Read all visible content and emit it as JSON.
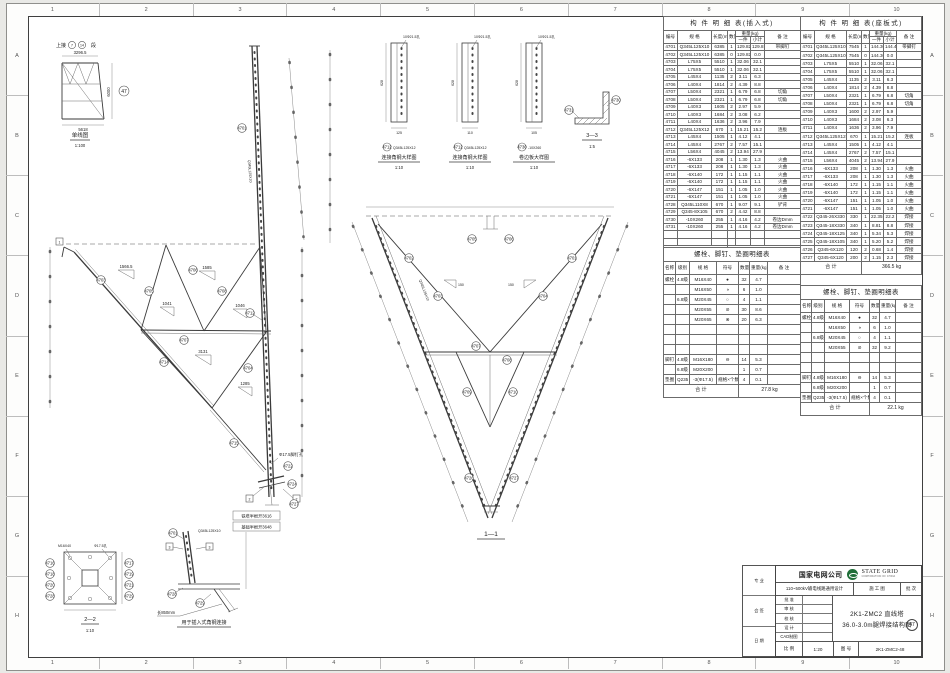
{
  "grid": {
    "cols": [
      "1",
      "2",
      "3",
      "4",
      "5",
      "6",
      "7",
      "8",
      "9",
      "10"
    ],
    "rows": [
      "A",
      "B",
      "C",
      "D",
      "E",
      "F",
      "G",
      "H"
    ]
  },
  "single_line": {
    "link_prefix": "上接",
    "seg1": "7",
    "seg2": "14",
    "link_suffix": "段",
    "dim_top": "3296.5",
    "dim_bottom": "5618",
    "dim_right": "6000",
    "ref": "47",
    "caption": "单线图",
    "scale": "1:100"
  },
  "refs": {
    "47": "47",
    "4701": "4701",
    "4702": "4702",
    "4703": "4703",
    "4704": "4704",
    "4705": "4705",
    "4706": "4706",
    "4707": "4707",
    "4708": "4708",
    "4709": "4709",
    "4710": "4710",
    "4712": "4712",
    "4713": "4713",
    "4714": "4714",
    "4715": "4715",
    "4716": "4716",
    "4717": "4717",
    "4718": "4718",
    "4719": "4719",
    "4720": "4720",
    "4721": "4721",
    "4722": "4722",
    "4724": "4724",
    "4726": "4726",
    "4727": "4727",
    "4728": "4728",
    "4729": "4729",
    "4730": "4730",
    "4731": "4731"
  },
  "dims": {
    "d1566": "1566.5",
    "d1585": "1585",
    "d1041": "1041",
    "d1046": "1046",
    "d3131": "3131",
    "d1285": "1285",
    "d628": "628",
    "d125": "125",
    "d110": "110",
    "d105": "105",
    "d150": "150"
  },
  "notes": {
    "half_root_tower": "铁塔半根开3616",
    "half_root_found": "基础半根开3648",
    "foot_hole": "Φ17.5脚钉孔",
    "hole10": "10Φ21.5孔",
    "len850": "长850mm",
    "insert_caption": "用于插入式角钢连接",
    "sec11": "1—1",
    "sec22": "2—2",
    "sec33": "3—3",
    "scale110": "1:10",
    "scale15": "1:5",
    "spec_leg": "Q345L125X10",
    "spec_conn": "Q345L125X12",
    "m16": "M16X40",
    "hole17": "Φ17.5孔",
    "f1": "1",
    "f2": "2",
    "f3": "3"
  },
  "strips": [
    {
      "ref": "4712",
      "spec": "Q345L125X12",
      "caption": "连接角钢大样图",
      "scale": "1:10",
      "width": "125"
    },
    {
      "ref": "4712",
      "spec": "Q345L125X12",
      "caption": "连接角钢大样图",
      "scale": "1:10",
      "width": "110"
    },
    {
      "ref": "4730",
      "spec": "-10X260",
      "caption": "卷边板大样图",
      "scale": "1:10",
      "width": "105"
    }
  ],
  "tables": {
    "headers": {
      "no": "编号",
      "spec": "规 格",
      "len": "长度(mm)",
      "qty": "数量",
      "weight": "重量(kg)",
      "one": "一件",
      "sub": "小计",
      "note": "备 注"
    },
    "total_label": "合 计",
    "insert": {
      "title": "构 件 明 细 表(插入式)",
      "total": "338.0 kg",
      "rows": [
        [
          "4701",
          "Q345L125X10",
          "6385",
          "1",
          "129.82",
          "129.8",
          "带脚钉"
        ],
        [
          "4702",
          "Q345L125X10",
          "6385",
          "0",
          "129.82",
          "0.0",
          ""
        ],
        [
          "4703",
          "L75X5",
          "5510",
          "1",
          "32.06",
          "32.1",
          ""
        ],
        [
          "4704",
          "L75X5",
          "5510",
          "1",
          "32.06",
          "32.1",
          ""
        ],
        [
          "4705",
          "L45X4",
          "1135",
          "2",
          "3.11",
          "6.3",
          ""
        ],
        [
          "4706",
          "L40X4",
          "1814",
          "2",
          "4.39",
          "8.8",
          ""
        ],
        [
          "4707",
          "L50X4",
          "2321",
          "1",
          "6.79",
          "6.8",
          "切角"
        ],
        [
          "4708",
          "L50X4",
          "2321",
          "1",
          "6.79",
          "6.8",
          "切角"
        ],
        [
          "4709",
          "L40X3",
          "1605",
          "2",
          "2.97",
          "5.9",
          ""
        ],
        [
          "4710",
          "L40X3",
          "1684",
          "2",
          "3.08",
          "6.2",
          ""
        ],
        [
          "4711",
          "L40X4",
          "1636",
          "2",
          "3.96",
          "7.9",
          ""
        ],
        [
          "4712",
          "Q345L125X12",
          "670",
          "1",
          "15.21",
          "15.2",
          "连板"
        ],
        [
          "4713",
          "L45X4",
          "1505",
          "1",
          "4.12",
          "4.1",
          ""
        ],
        [
          "4714",
          "L45X4",
          "2767",
          "2",
          "7.57",
          "15.1",
          ""
        ],
        [
          "4715",
          "L56X4",
          "4045",
          "2",
          "13.94",
          "27.9",
          ""
        ],
        [
          "4716",
          "-6X133",
          "208",
          "1",
          "1.30",
          "1.3",
          "火曲"
        ],
        [
          "4717",
          "-6X133",
          "208",
          "1",
          "1.30",
          "1.3",
          "火曲"
        ],
        [
          "4718",
          "-6X140",
          "172",
          "1",
          "1.15",
          "1.1",
          "火曲"
        ],
        [
          "4719",
          "-6X140",
          "172",
          "1",
          "1.15",
          "1.1",
          "火曲"
        ],
        [
          "4720",
          "-6X147",
          "151",
          "1",
          "1.05",
          "1.0",
          "火曲"
        ],
        [
          "4721",
          "-6X147",
          "151",
          "1",
          "1.05",
          "1.0",
          "火曲"
        ],
        [
          "4728",
          "Q345L110X8",
          "670",
          "1",
          "9.07",
          "9.1",
          "铲背"
        ],
        [
          "4729",
          "Q345-8X105",
          "670",
          "2",
          "4.42",
          "8.8",
          ""
        ],
        [
          "4730",
          "-10X260",
          "255",
          "1",
          "4.16",
          "4.2",
          "卷边Dmm"
        ],
        [
          "4731",
          "-10X260",
          "255",
          "1",
          "4.16",
          "4.2",
          "卷边Dmm"
        ],
        [
          "",
          "",
          "",
          "",
          "",
          "",
          ""
        ],
        [
          "",
          "",
          "",
          "",
          "",
          "",
          ""
        ]
      ]
    },
    "seat": {
      "title": "构 件 明 细 表(座板式)",
      "total": "366.5 kg",
      "rows": [
        [
          "4701",
          "Q345L125X10",
          "7545",
          "1",
          "144.36",
          "144.4",
          "带脚钉"
        ],
        [
          "4702",
          "Q345L125X10",
          "7545",
          "0",
          "144.36",
          "0.0",
          ""
        ],
        [
          "4703",
          "L75X5",
          "5510",
          "1",
          "32.06",
          "32.1",
          ""
        ],
        [
          "4704",
          "L75X5",
          "5510",
          "1",
          "32.06",
          "32.1",
          ""
        ],
        [
          "4705",
          "L45X4",
          "1135",
          "2",
          "3.11",
          "6.3",
          ""
        ],
        [
          "4706",
          "L40X4",
          "1814",
          "2",
          "4.39",
          "8.8",
          ""
        ],
        [
          "4707",
          "L50X4",
          "2321",
          "1",
          "6.79",
          "6.8",
          "切角"
        ],
        [
          "4708",
          "L50X4",
          "2321",
          "1",
          "6.79",
          "6.8",
          "切角"
        ],
        [
          "4709",
          "L40X3",
          "1600",
          "2",
          "2.97",
          "5.9",
          ""
        ],
        [
          "4710",
          "L40X3",
          "1684",
          "2",
          "3.08",
          "6.3",
          ""
        ],
        [
          "4711",
          "L40X4",
          "1636",
          "2",
          "3.96",
          "7.9",
          ""
        ],
        [
          "4712",
          "Q345L125X12",
          "670",
          "1",
          "15.21",
          "15.2",
          "连板"
        ],
        [
          "4713",
          "L45X4",
          "1505",
          "1",
          "4.12",
          "4.1",
          ""
        ],
        [
          "4714",
          "L45X4",
          "2767",
          "2",
          "7.57",
          "15.1",
          ""
        ],
        [
          "4715",
          "L56X4",
          "4045",
          "2",
          "13.94",
          "27.9",
          ""
        ],
        [
          "4716",
          "-6X133",
          "208",
          "1",
          "1.30",
          "1.3",
          "火曲"
        ],
        [
          "4717",
          "-6X133",
          "208",
          "1",
          "1.30",
          "1.3",
          "火曲"
        ],
        [
          "4718",
          "-6X140",
          "172",
          "1",
          "1.15",
          "1.1",
          "火曲"
        ],
        [
          "4719",
          "-6X140",
          "172",
          "1",
          "1.15",
          "1.1",
          "火曲"
        ],
        [
          "4720",
          "-6X147",
          "151",
          "1",
          "1.05",
          "1.0",
          "火曲"
        ],
        [
          "4721",
          "-6X147",
          "151",
          "1",
          "1.05",
          "1.0",
          "火曲"
        ],
        [
          "4722",
          "Q345-26X330",
          "330",
          "1",
          "22.35",
          "22.2",
          "焊接"
        ],
        [
          "4723",
          "Q345-18X330",
          "340",
          "1",
          "8.81",
          "8.8",
          "焊接"
        ],
        [
          "4724",
          "Q345-18X125",
          "340",
          "1",
          "5.34",
          "5.3",
          "焊接"
        ],
        [
          "4725",
          "Q345-18X105",
          "340",
          "1",
          "5.20",
          "5.2",
          "焊接"
        ],
        [
          "4726",
          "Q345-6X120",
          "120",
          "2",
          "0.68",
          "1.4",
          "焊接"
        ],
        [
          "4727",
          "Q345-6X120",
          "200",
          "2",
          "1.15",
          "2.3",
          "焊接"
        ]
      ]
    },
    "bolt_headers": [
      "名称",
      "级别",
      "规 格",
      "符号",
      "数量",
      "重量(kg)",
      "备 注"
    ],
    "bolts_insert": {
      "title": "螺栓、脚钉、垫圈明细表",
      "total": "27.8 kg",
      "rows": [
        [
          "螺栓",
          "4.8级",
          "M16X40",
          "●",
          "32",
          "4.7",
          ""
        ],
        [
          "",
          "",
          "M16X50",
          "◑",
          "6",
          "1.0",
          ""
        ],
        [
          "",
          "6.8级",
          "M20X45",
          "○",
          "4",
          "1.1",
          ""
        ],
        [
          "",
          "",
          "M20X55",
          "⊘",
          "30",
          "8.6",
          ""
        ],
        [
          "",
          "",
          "M20X65",
          "⊗",
          "20",
          "6.3",
          ""
        ],
        [
          "",
          "",
          "",
          "",
          "",
          "",
          ""
        ],
        [
          "",
          "",
          "",
          "",
          "",
          "",
          ""
        ],
        [
          "",
          "",
          "",
          "",
          "",
          "",
          ""
        ],
        [
          "脚钉",
          "4.8级",
          "M16X180",
          "⊖",
          "14",
          "5.3",
          ""
        ],
        [
          "",
          "6.8级",
          "M20X200",
          "",
          "1",
          "0.7",
          ""
        ],
        [
          "垫圈",
          "Q235",
          "-3(Φ17.5)",
          "规格×个数",
          "4",
          "0.1",
          ""
        ]
      ]
    },
    "bolts_seat": {
      "title": "螺栓、脚钉、垫圈明细表",
      "total": "22.1 kg",
      "rows": [
        [
          "螺栓",
          "4.8级",
          "M16X40",
          "●",
          "32",
          "4.7",
          ""
        ],
        [
          "",
          "",
          "M16X50",
          "◑",
          "6",
          "1.0",
          ""
        ],
        [
          "",
          "6.8级",
          "M20X45",
          "○",
          "4",
          "1.1",
          ""
        ],
        [
          "",
          "",
          "M20X55",
          "⊘",
          "32",
          "9.2",
          ""
        ],
        [
          "",
          "",
          "",
          "",
          "",
          "",
          ""
        ],
        [
          "",
          "",
          "",
          "",
          "",
          "",
          ""
        ],
        [
          "脚钉",
          "4.8级",
          "M16X180",
          "⊖",
          "14",
          "5.3",
          ""
        ],
        [
          "",
          "6.8级",
          "M20X200",
          "",
          "1",
          "0.7",
          ""
        ],
        [
          "垫圈",
          "Q235",
          "-3(Φ17.5)",
          "规格×个数",
          "4",
          "0.1",
          ""
        ]
      ]
    }
  },
  "title_block": {
    "company": "国家电网公司",
    "logo_line1": "STATE GRID",
    "logo_line2": "CORPORATION OF CHINA",
    "logo_color": "#1f6e38",
    "project": "110~500kV输电线路通用设计",
    "stage": "施 工 图",
    "batch": "批 次",
    "approval_labels": [
      "批 准",
      "审 核",
      "校 核",
      "设 计",
      "CAD制图"
    ],
    "title_line1": "2K1-ZMC2 直线塔",
    "title_line2": "36.0-3.0m腿焊接结构图",
    "title_ref": "47",
    "scale_label": "比 例",
    "scale": "1:20",
    "no_label": "图 号",
    "drawing_no": "2K1-ZMC2-48",
    "sign_labels": [
      "专 业",
      "会 签",
      "日 期"
    ]
  }
}
